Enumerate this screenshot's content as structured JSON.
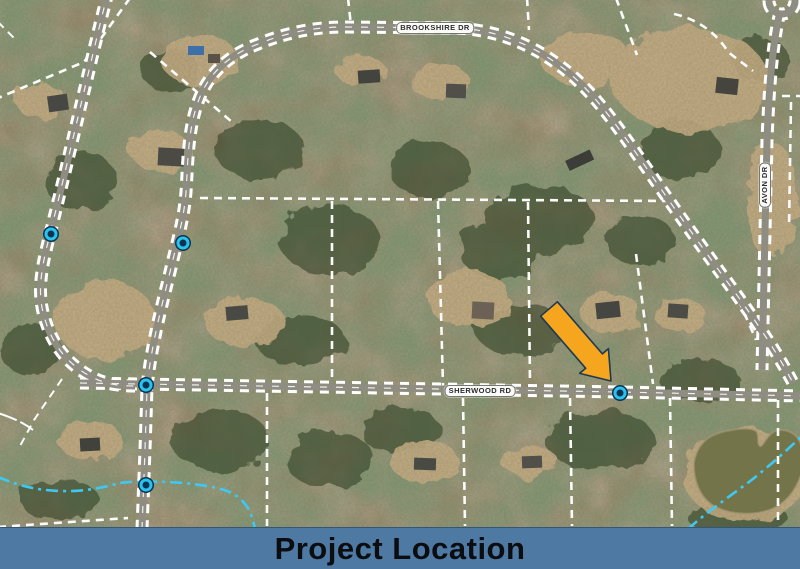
{
  "banner": {
    "title": "Project Location",
    "bg_color": "#4d79a3",
    "text_color": "#0b0d10"
  },
  "map": {
    "type": "aerial-parcel-map",
    "road_labels": [
      {
        "id": "brookshire-dr",
        "text": "BROOKSHIRE DR",
        "x": 435,
        "y": 28,
        "orientation": "horizontal"
      },
      {
        "id": "sherwood-rd",
        "text": "SHERWOOD RD",
        "x": 480,
        "y": 391,
        "orientation": "horizontal"
      },
      {
        "id": "avon-dr",
        "text": "AVON DR",
        "x": 765,
        "y": 185,
        "orientation": "vertical"
      }
    ],
    "markers": [
      {
        "id": "marker-1",
        "x": 51,
        "y": 234
      },
      {
        "id": "marker-2",
        "x": 183,
        "y": 243
      },
      {
        "id": "marker-3",
        "x": 146,
        "y": 385
      },
      {
        "id": "marker-4",
        "x": 146,
        "y": 485
      },
      {
        "id": "marker-5",
        "x": 620,
        "y": 393
      }
    ],
    "arrow": {
      "meaning": "points to project location on Sherwood Rd",
      "tail": {
        "x": 549,
        "y": 309
      },
      "tip": {
        "x": 611,
        "y": 381
      },
      "color": "#f6a51f",
      "outline": "#1c3a50"
    },
    "colors": {
      "marker_ring": "#29c3f0",
      "marker_core": "#0c3350",
      "stream": "#3ec9f4",
      "road_edge_dash": "#ffffff",
      "road_surface": "#8f8d82",
      "parcel_line": "#ffffff",
      "pond_water": "#74744a"
    }
  }
}
